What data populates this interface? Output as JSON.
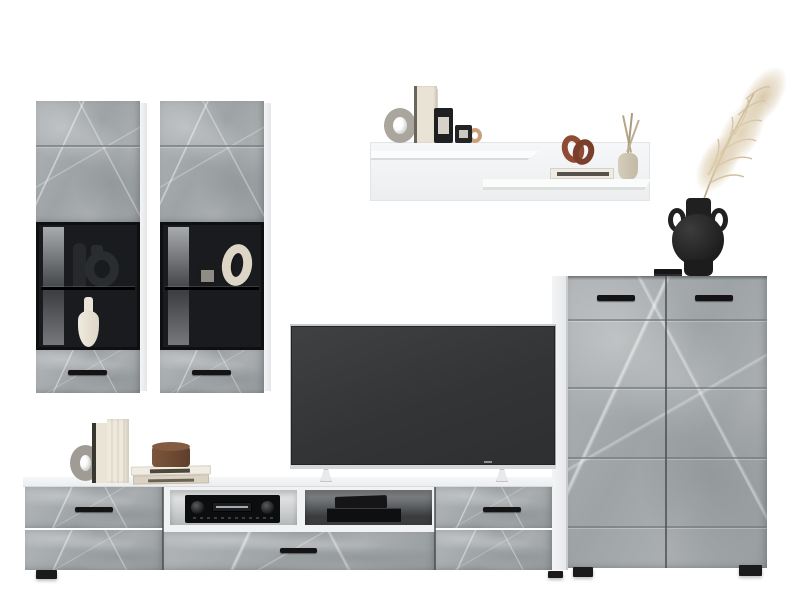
{
  "meta": {
    "domain": "natural-image",
    "subject": "living room wall-unit furniture set product photo",
    "background_color": "#ffffff"
  },
  "palette": {
    "concrete_light": "#b1b5b7",
    "concrete_mid": "#9ea3a5",
    "concrete_dark": "#979c9f",
    "groove": "#767c7e",
    "carcass_white": "#f2f3f4",
    "interior_black": "#1a1b1e",
    "handle_black": "#141414",
    "tv_screen": "#37383a",
    "tv_trim_silver": "#d5d7d8",
    "pampas_beige": "#dbcba9",
    "vase_black": "#232323",
    "knot_rust": "#8a4a32",
    "book_cream": "#eae4d7",
    "candle_brown": "#6f4b34"
  },
  "furniture": {
    "wall_cabinet_left": {
      "finish": "concrete gray front, white carcass",
      "sections": [
        "top door panel",
        "dark glass display",
        "bottom drawer with black handle"
      ],
      "display_items": [
        "dark-bottle-vase",
        "dark-jug-sculpture",
        "white-bottle-vase"
      ]
    },
    "wall_cabinet_right": {
      "finish": "concrete gray front, white carcass",
      "sections": [
        "top door panel",
        "dark glass display",
        "bottom drawer with black handle"
      ],
      "display_items": [
        "black-candle-jar",
        "cream-ring-sculpture"
      ]
    },
    "wall_shelf": {
      "finish": "white",
      "tiers": 2,
      "upper_decor": [
        "gray-donut-bookend",
        "standing-books",
        "black-candle-jar-tall",
        "black-candle-jar-short",
        "tan-ring-sculpture"
      ],
      "lower_decor": [
        "lying-book",
        "rust-knot-sculpture",
        "bud-vase-with-twigs"
      ]
    },
    "tall_cabinet": {
      "finish": "concrete gray fronts, white side panel",
      "doors": 2,
      "handles": 2,
      "feet": 2,
      "top_decor": [
        "black-flat-books",
        "black-round-vase-with-pampas-grass"
      ]
    },
    "tv_stand": {
      "finish": "concrete gray fronts, white top",
      "drawers": [
        "left-drawer",
        "bottom-center-drawer",
        "right-drawer"
      ],
      "open_niches": [
        "av-receiver",
        "black-media-stack"
      ],
      "feet": 2,
      "top_decor": [
        "gray-ring-bookend",
        "standing-books",
        "stacked-books",
        "brown-candle"
      ]
    },
    "tv": {
      "state": "screen off",
      "frame": "thin silver",
      "legs": 2
    }
  }
}
